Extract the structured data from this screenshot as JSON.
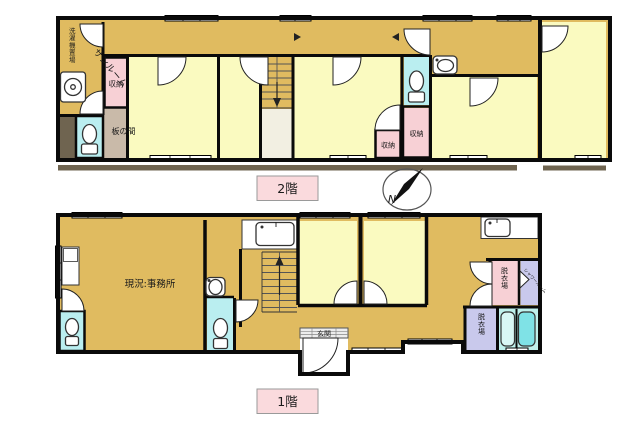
{
  "floor2": {
    "label": "2階",
    "rooms": {
      "laundry_area": "洗濯機置場",
      "sunroom": "サンルーム",
      "closet_left": "収納",
      "itanoma": "板の間",
      "closet_mid": "収納",
      "closet_right": "収納"
    }
  },
  "floor1": {
    "label": "1階",
    "rooms": {
      "office": "現況:事務所",
      "entrance": "玄関",
      "dressing_upper": "脱衣場",
      "shower_room": "シャワールーム",
      "dressing_lower": "脱衣場"
    }
  },
  "compass": {
    "north_label": "N"
  },
  "colors": {
    "corridor_ochre": "#e0bb60",
    "room_yellow": "#fafac0",
    "closet_pink": "#f7d0d5",
    "toilet_cyan": "#baeef0",
    "bath_cyan": "#bff0ec",
    "tub_cyan": "#7fe2e6",
    "washtub_cyan": "#d9f7f5",
    "lavender": "#c9c9ec",
    "itanoma_taupe": "#c9baa9",
    "balcony_brown": "#6f6450",
    "floor_label_pink": "#fadadd",
    "understairs_cream": "#f2efe2"
  }
}
